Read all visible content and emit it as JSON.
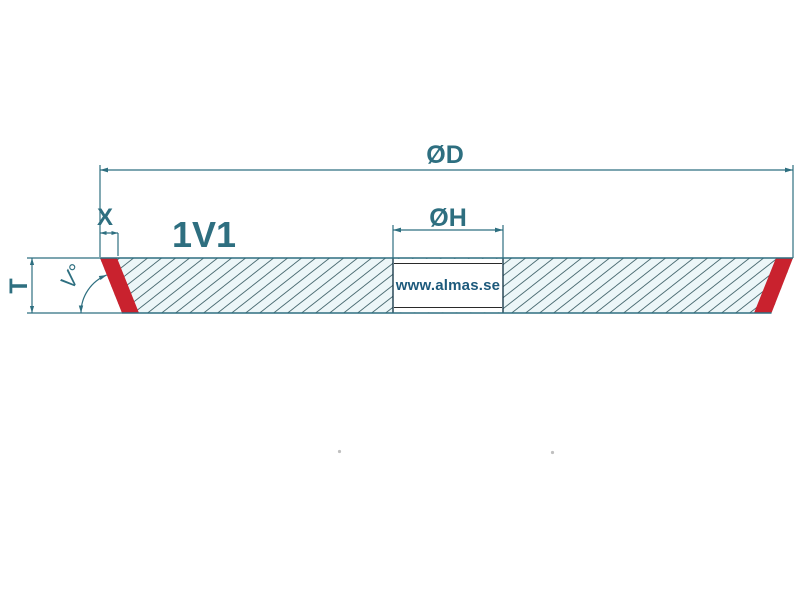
{
  "diagram": {
    "profile_code": "1V1",
    "dimension_labels": {
      "outer_diameter": "ØD",
      "bore_diameter": "ØH",
      "rim_depth": "X",
      "thickness": "T",
      "angle": "V°"
    },
    "watermark": "www.almas.se",
    "colors": {
      "line": "#2e6f80",
      "red": "#c9222e",
      "hatch": "#4a6b72",
      "body_fill": "#ecf6f8",
      "bore_line": "#1c3d4d",
      "watermark_text": "#1d5a7c"
    }
  }
}
